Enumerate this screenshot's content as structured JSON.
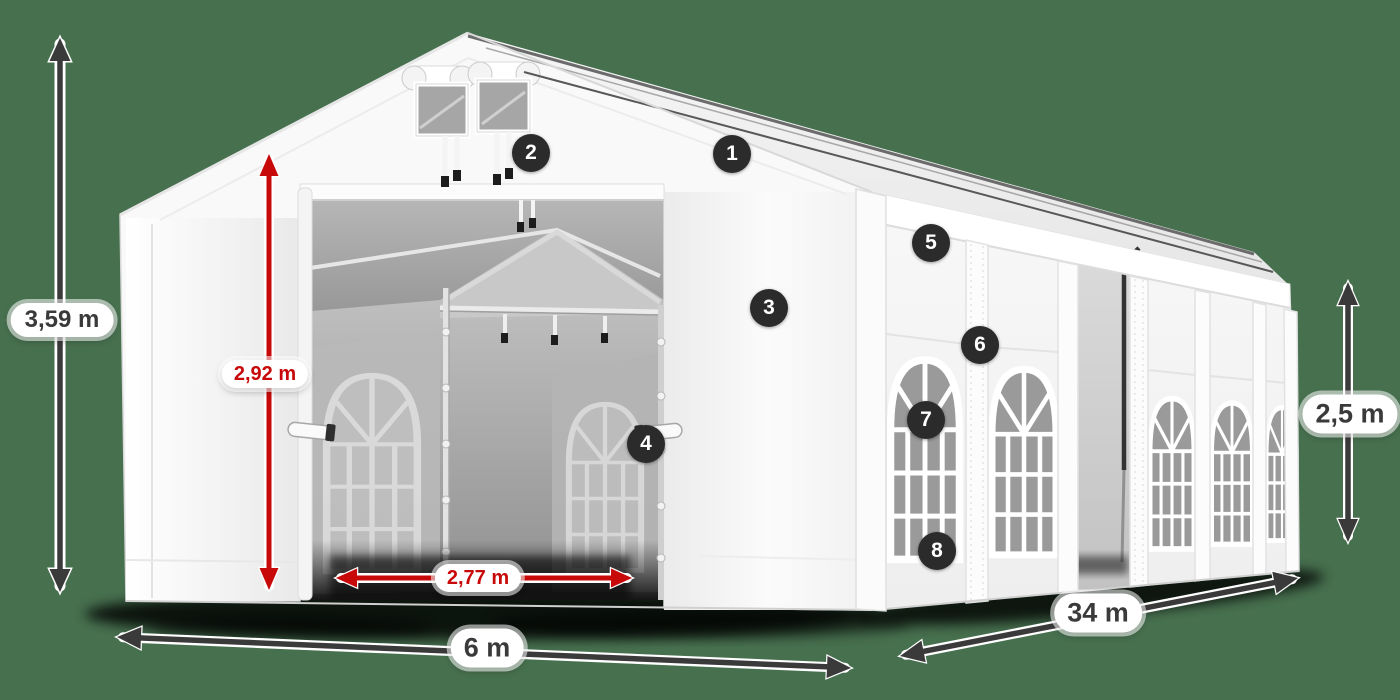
{
  "diagram": {
    "subject": "party-tent-dimension-diagram",
    "colors": {
      "background": "#47704f",
      "arrow_dark": "#3a3a3a",
      "arrow_red": "#c80909",
      "badge_background": "#2b2b2b",
      "badge_text": "#ffffff",
      "tent_canvas": "#f8f8f8"
    },
    "dimensions": {
      "total_height": {
        "value": "3,59 m"
      },
      "entrance_height": {
        "value": "2,92 m"
      },
      "entrance_width": {
        "value": "2,77 m"
      },
      "front_width": {
        "value": "6 m"
      },
      "side_length": {
        "value": "34 m"
      },
      "side_wall_height": {
        "value": "2,5 m"
      }
    },
    "markers": [
      {
        "number": "1"
      },
      {
        "number": "2"
      },
      {
        "number": "3"
      },
      {
        "number": "4"
      },
      {
        "number": "5"
      },
      {
        "number": "6"
      },
      {
        "number": "7"
      },
      {
        "number": "8"
      }
    ]
  }
}
